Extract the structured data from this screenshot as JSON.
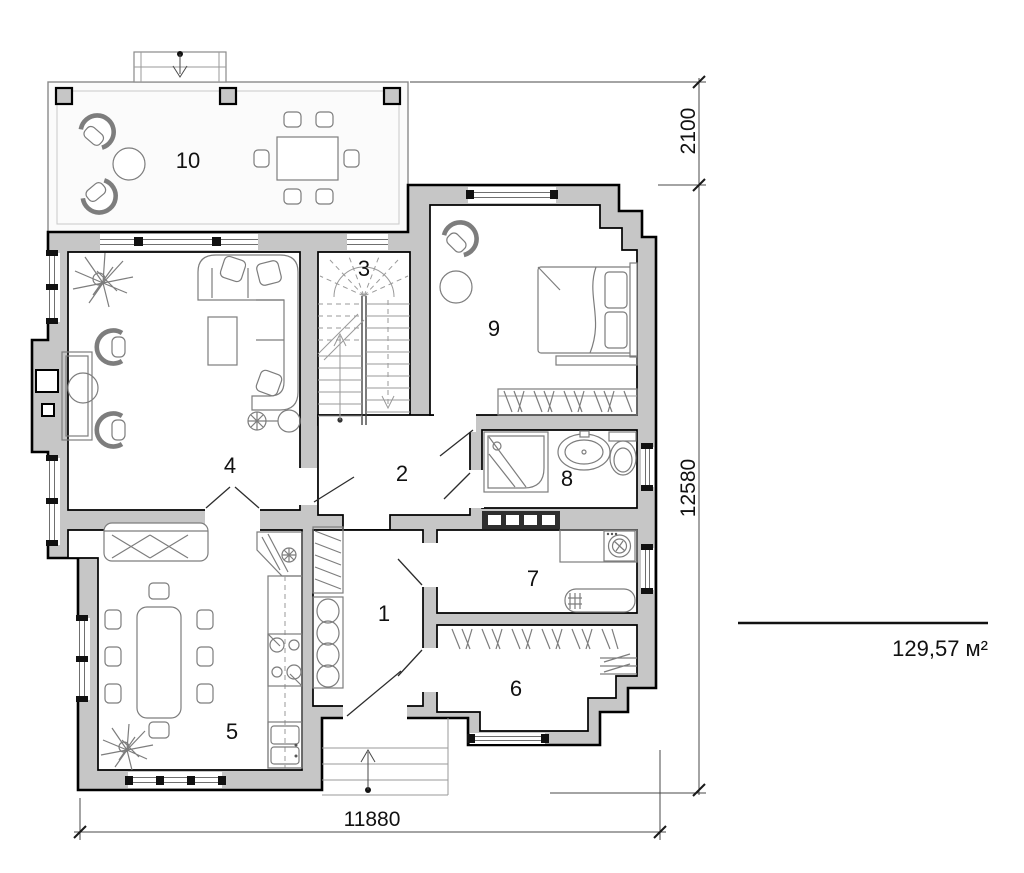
{
  "plan": {
    "rooms": [
      {
        "num": "1"
      },
      {
        "num": "2"
      },
      {
        "num": "3"
      },
      {
        "num": "4"
      },
      {
        "num": "5"
      },
      {
        "num": "6"
      },
      {
        "num": "7"
      },
      {
        "num": "8"
      },
      {
        "num": "9"
      },
      {
        "num": "10"
      }
    ],
    "dimensions": {
      "terrace_depth": "2100",
      "side": "12580",
      "front": "11880"
    },
    "total_area": "129,57 м²",
    "colors": {
      "wall_fill": "#c6c6c6",
      "wall_line": "#000000",
      "furniture_line": "#7d7d7d",
      "dimension_line": "#4a4a4a"
    }
  }
}
